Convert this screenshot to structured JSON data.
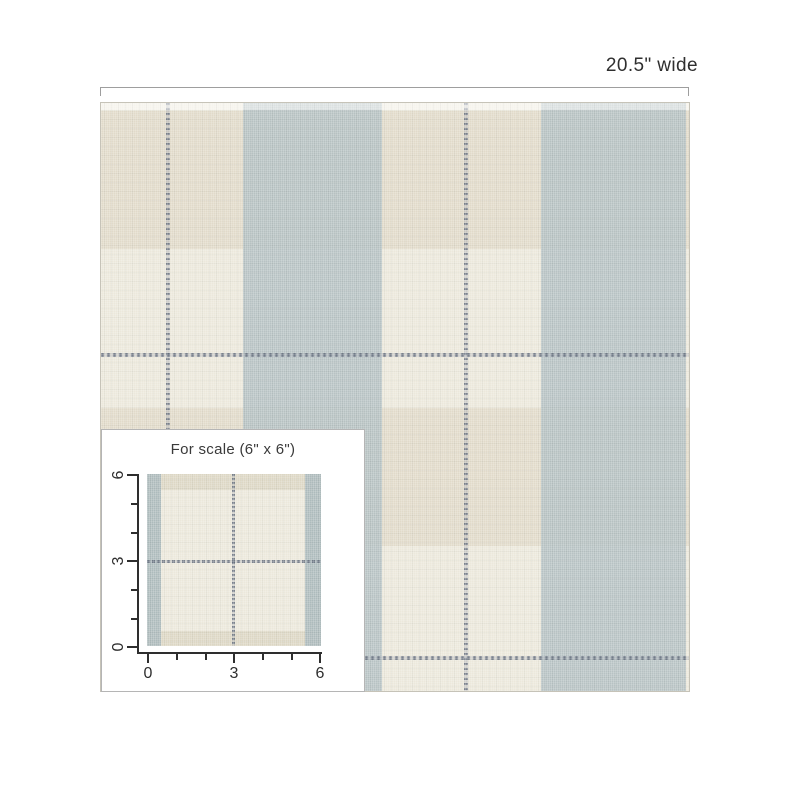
{
  "dimension": {
    "width_label": "20.5\" wide"
  },
  "swatch": {
    "description": "cream and slate-blue linen buffalo plaid wallpaper",
    "colors": {
      "cream": "#ece8db",
      "blue_band": "#b7c2c3",
      "beige_band": "#e2dbc8",
      "pinstripe": "#77808e",
      "border": "#c6c3b8"
    }
  },
  "scale_inset": {
    "title": "For scale (6\" x 6\")",
    "x_axis": {
      "tick_labels": [
        "0",
        "3",
        "6"
      ]
    },
    "y_axis": {
      "tick_labels": [
        "6",
        "3",
        "0"
      ]
    }
  }
}
